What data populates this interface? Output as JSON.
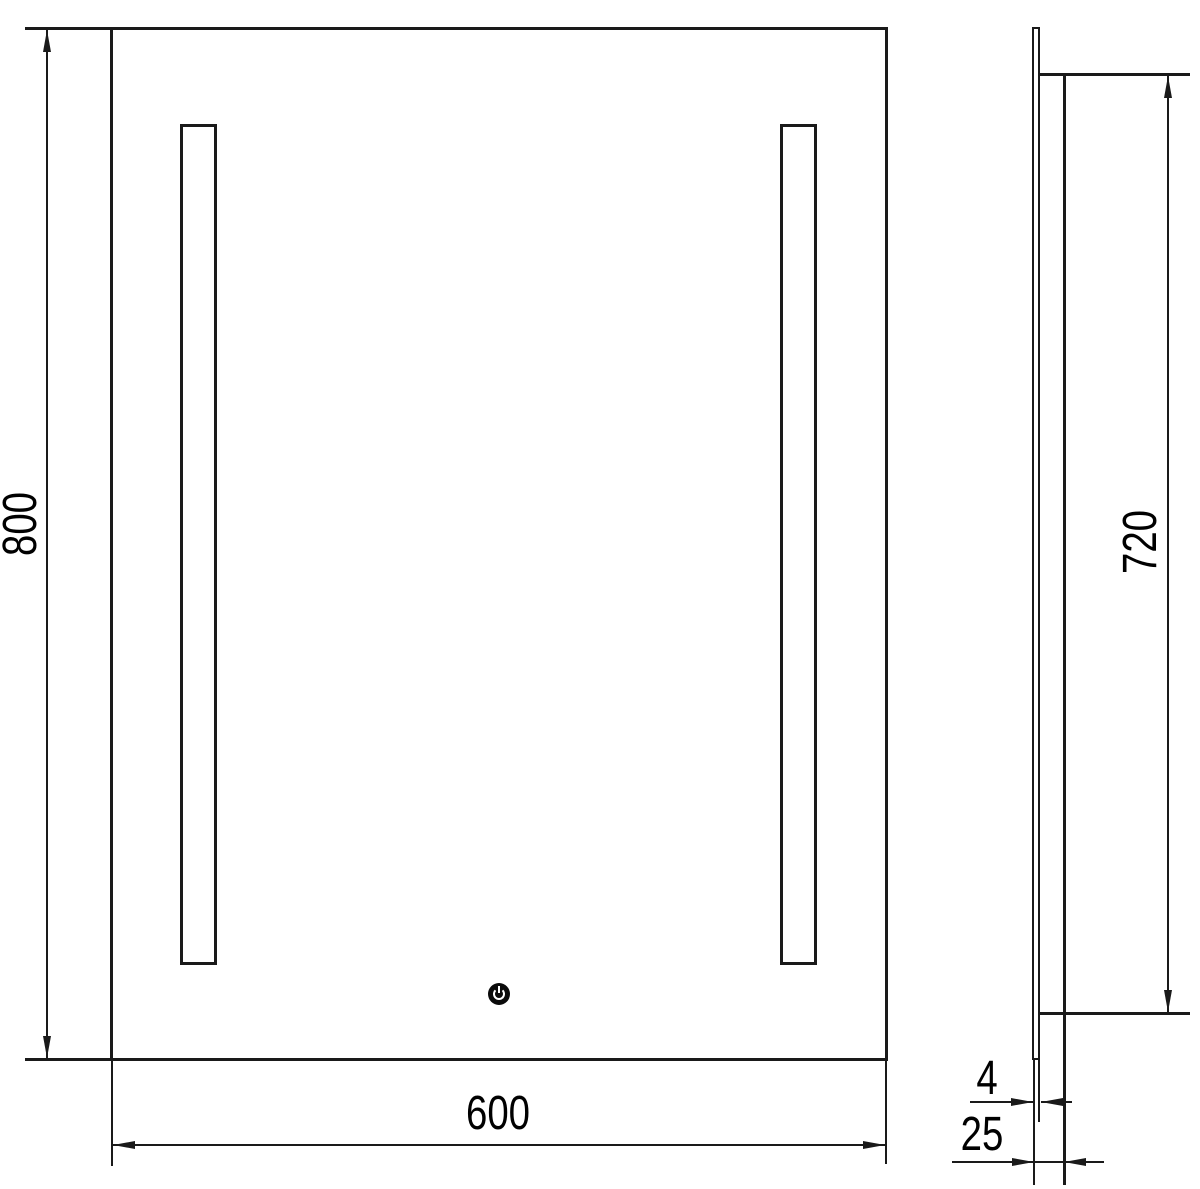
{
  "drawing": {
    "type": "technical-dimension-drawing",
    "subject": "illuminated bathroom mirror with two vertical light strips and touch power button",
    "views": [
      "front-view",
      "side-view"
    ]
  },
  "labels": {
    "mirror_height": "800",
    "mirror_width": "600",
    "illuminated_height": "720",
    "glass_thickness": "4",
    "mirror_depth": "25"
  },
  "icons": {
    "power_button": "power-icon"
  },
  "colors": {
    "background": "#ffffff",
    "line": "#1a1a1a",
    "text": "#000000",
    "power_button_fill": "#0a0a0a",
    "power_symbol": "#ffffff"
  }
}
